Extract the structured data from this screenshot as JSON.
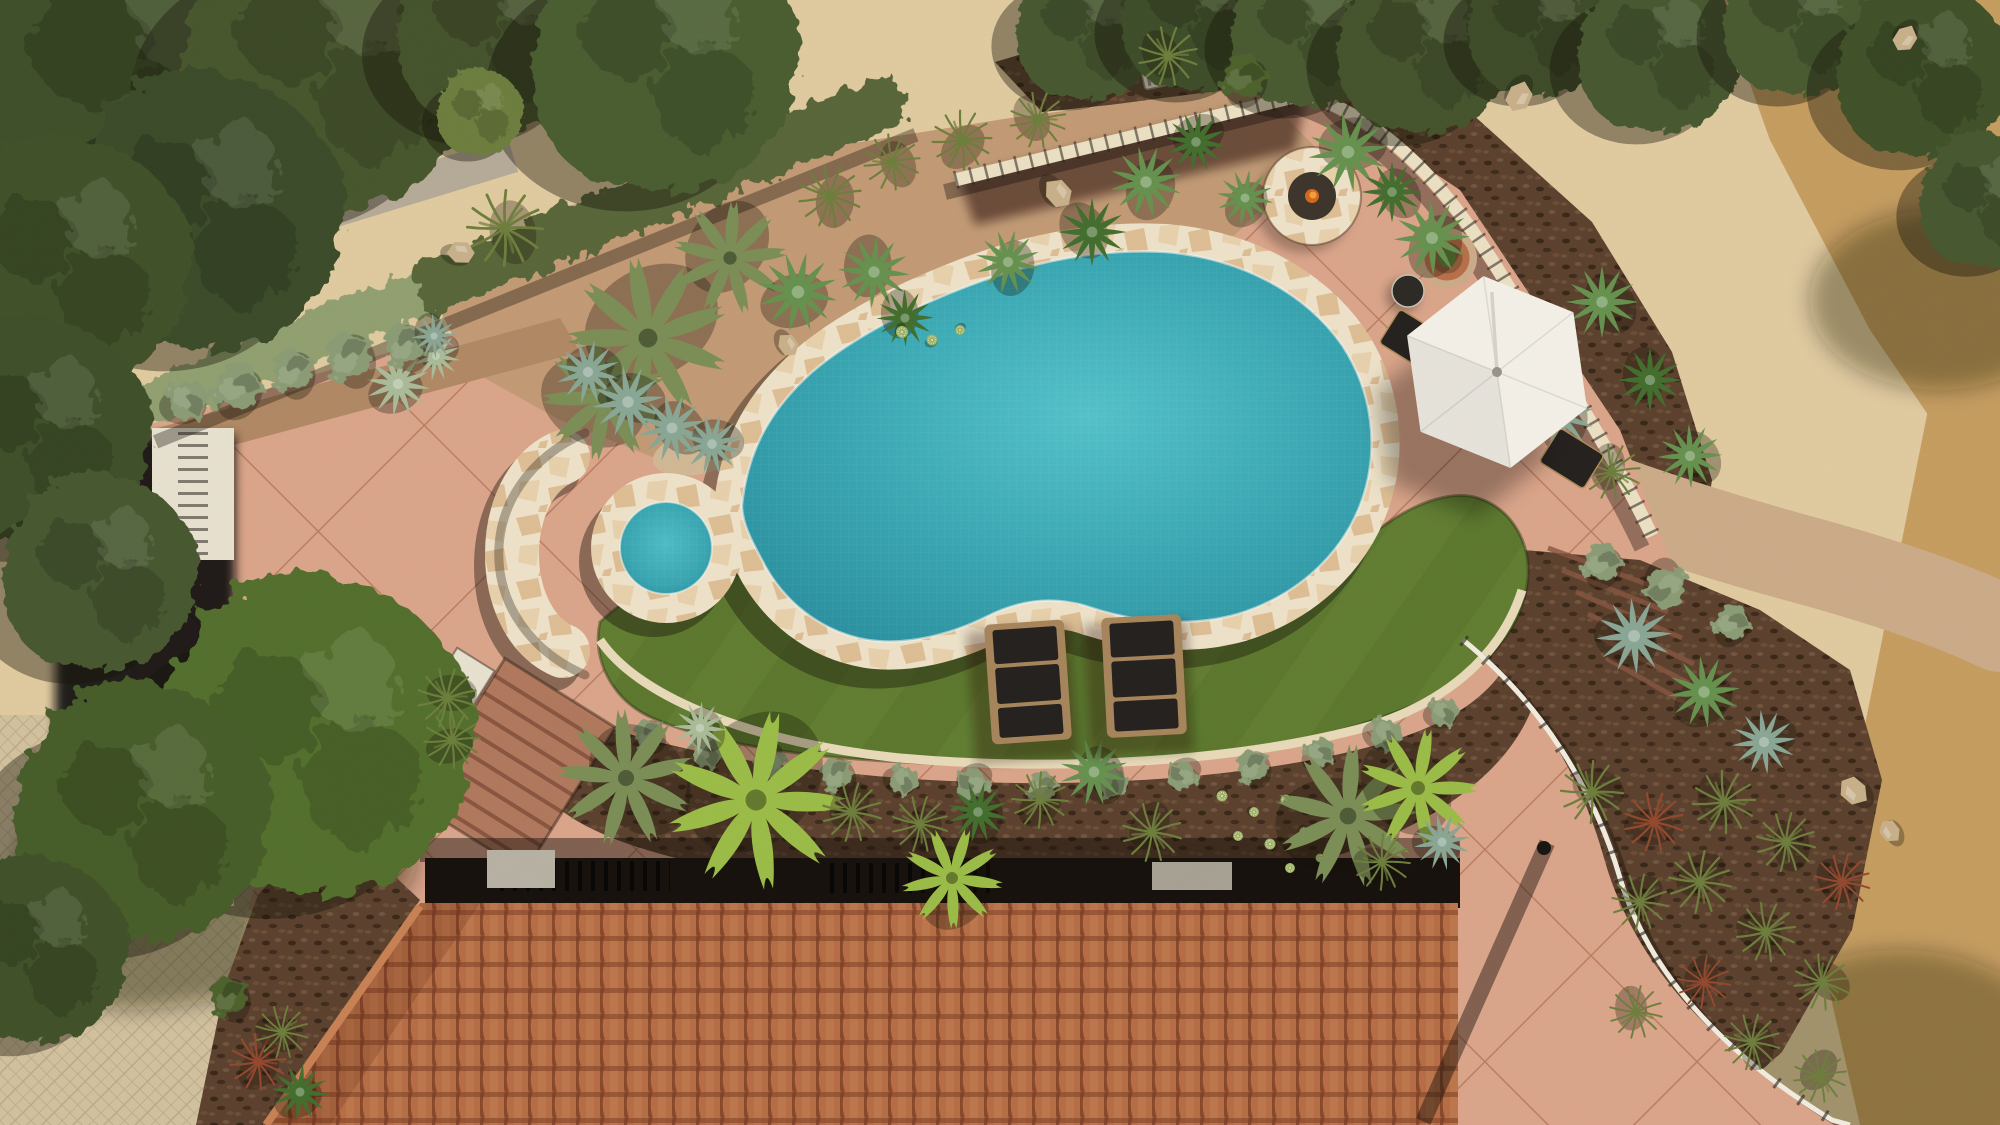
{
  "scene_title": "aerial-backyard-pool-landscape-render",
  "canvas": {
    "width": 2000,
    "height": 1125
  },
  "palette": {
    "sand": "#E2CCA2",
    "sandDark": "#C79F62",
    "gravel": "#B7AC9A",
    "dgBed": "#C49C77",
    "dgBedDark": "#B28A66",
    "dgPath": "#CDAD8A",
    "pebble": "#D3BA97",
    "patio": "#DCA78C",
    "patioLine": "#B27257",
    "flagBase": "#EFE4CB",
    "flagStone1": "#DFC096",
    "flagStone2": "#E9D3AE",
    "water": "#3BAAB6",
    "lawn": "#5E7A2F",
    "lawnLight": "#7A9040",
    "mulch": "#5D432F",
    "mulchLight": "#6E523A",
    "hedgeDark": "#5A683A",
    "hedgeSage": "#93A272",
    "roof": "#B76F47",
    "roofRib": "#8A4A2C",
    "roofLight": "#C98355",
    "roofRow": "#7E4126",
    "drive": "#D3C3A1",
    "driveLine": "#BCAA86",
    "wallCap": "#EDE2C6",
    "wallWhite": "#E9E3D2",
    "wallGray": "#CFC8B6",
    "shadow": "#17120D",
    "umbrella": "#F5F2EA",
    "chairDark": "#262220",
    "chairFrame": "#A8875D",
    "curb": "#E9DCBB",
    "stepTread": "#8A5742",
    "stepPad": "#B27A5F",
    "railing": "#F2EEE2",
    "firepitInner": "#3E362C",
    "flame": "#D4691F",
    "flameLight": "#F2A23C",
    "potRing": "#B9714C",
    "potPlant": "#5E7F3A",
    "plantColors": {
      "palm": "#7D9058",
      "palmBright": "#9DBE49",
      "agave": "#679350",
      "agaveDark": "#44702F",
      "agaveBlue": "#8BA897",
      "agavePale": "#ABBD9B",
      "grass": "#6F803E",
      "grassRed": "#964A30",
      "barrel": "#9FB468",
      "shrub": "#50642F",
      "shrubSage": "#8C9E77",
      "rock": "#C9B28C"
    }
  },
  "scene": {
    "objects": [
      "freeform swimming pool",
      "round spa",
      "flagstone coping",
      "crescent step pad",
      "kidney lawn",
      "2 lounge chairs",
      "hex patio umbrella",
      "2 patio chairs",
      "side table",
      "gas fire pit",
      "salmon concrete patio",
      "curved garden wall",
      "white view railing",
      "tile roof",
      "herringbone driveway",
      "trimmed hedge",
      "desert planting beds",
      "decomposed granite path",
      "paver steps",
      "planter pot",
      "slat bench"
    ],
    "counts": {
      "lounge_chairs": 2,
      "patio_chairs": 2,
      "umbrellas": 1,
      "fire_pits": 1
    },
    "trees": [
      [
        140,
        80,
        1.7,
        "#40512B"
      ],
      [
        330,
        60,
        1.45,
        "#49592F"
      ],
      [
        500,
        28,
        1.0,
        "#46552E"
      ],
      [
        665,
        58,
        1.3,
        "#4C5E33"
      ],
      [
        205,
        212,
        1.35,
        "#3E4E29"
      ],
      [
        68,
        262,
        1.2,
        "#43532C"
      ],
      [
        38,
        432,
        1.1,
        "#40512B"
      ],
      [
        100,
        572,
        0.95,
        "#4A5A30"
      ],
      [
        1088,
        28,
        0.7,
        "#4A5A30"
      ],
      [
        1198,
        14,
        0.75,
        "#414F2A"
      ],
      [
        1308,
        30,
        0.75,
        "#4C5C32"
      ],
      [
        1424,
        46,
        0.85,
        "#47562E"
      ],
      [
        1540,
        24,
        0.7,
        "#3F4E29"
      ],
      [
        1660,
        50,
        0.8,
        "#4A5A30"
      ],
      [
        1800,
        18,
        0.75,
        "#4C5C32"
      ],
      [
        1924,
        70,
        0.85,
        "#43522B"
      ],
      [
        1986,
        200,
        0.65,
        "#4A5A30"
      ],
      [
        315,
        736,
        1.55,
        "#55712F"
      ],
      [
        142,
        812,
        1.25,
        "#4A5E2C"
      ],
      [
        36,
        950,
        0.9,
        "#42522A"
      ],
      [
        480,
        112,
        0.42,
        "#6E8040"
      ]
    ],
    "plants": [
      [
        "palm",
        648,
        338,
        1.35
      ],
      [
        "palm",
        605,
        398,
        1.05
      ],
      [
        "palm",
        730,
        258,
        0.95
      ],
      [
        "agaveBlue",
        588,
        372,
        0.85
      ],
      [
        "agaveBlue",
        628,
        402,
        0.95
      ],
      [
        "agaveBlue",
        672,
        428,
        0.9
      ],
      [
        "agaveBlue",
        712,
        444,
        0.8
      ],
      [
        "agave",
        798,
        292,
        1.05
      ],
      [
        "agave",
        874,
        272,
        0.95
      ],
      [
        "agaveDark",
        905,
        318,
        0.75
      ],
      [
        "grass",
        830,
        196,
        0.95
      ],
      [
        "grass",
        892,
        162,
        0.85
      ],
      [
        "grass",
        962,
        140,
        0.9
      ],
      [
        "grass",
        1038,
        120,
        0.85
      ],
      [
        "barrel",
        902,
        332,
        0.55
      ],
      [
        "barrel",
        932,
        340,
        0.5
      ],
      [
        "barrel",
        960,
        330,
        0.45
      ],
      [
        "agave",
        1008,
        262,
        0.85
      ],
      [
        "agaveDark",
        1092,
        232,
        0.9
      ],
      [
        "agave",
        1146,
        182,
        0.95
      ],
      [
        "agaveDark",
        1196,
        142,
        0.8
      ],
      [
        "agave",
        1245,
        198,
        0.75
      ],
      [
        "rock",
        1058,
        192,
        0.9
      ],
      [
        "rock",
        788,
        344,
        0.7
      ],
      [
        "rock",
        460,
        252,
        0.8
      ],
      [
        "grass",
        505,
        228,
        1.15
      ],
      [
        "agavePale",
        398,
        384,
        0.85
      ],
      [
        "agavePale",
        436,
        356,
        0.65
      ],
      [
        "shrubSage",
        188,
        400,
        0.7
      ],
      [
        "shrubSage",
        238,
        386,
        0.8
      ],
      [
        "shrubSage",
        292,
        370,
        0.7
      ],
      [
        "shrubSage",
        348,
        356,
        0.8
      ],
      [
        "shrubSage",
        404,
        344,
        0.7
      ],
      [
        "agaveBlue",
        434,
        336,
        0.6
      ],
      [
        "grass",
        1168,
        56,
        0.9
      ],
      [
        "shrub",
        1244,
        76,
        0.75
      ],
      [
        "agave",
        1348,
        152,
        1.05
      ],
      [
        "agaveDark",
        1392,
        192,
        0.8
      ],
      [
        "agave",
        1432,
        238,
        1.0
      ],
      [
        "agave",
        1508,
        330,
        1.0
      ],
      [
        "agaveBlue",
        1560,
        416,
        0.9
      ],
      [
        "rock",
        1520,
        96,
        0.9
      ],
      [
        "rock",
        1906,
        38,
        0.8
      ],
      [
        "grass",
        1612,
        472,
        0.85
      ],
      [
        "agave",
        1602,
        302,
        0.95
      ],
      [
        "agaveDark",
        1650,
        380,
        0.85
      ],
      [
        "agave",
        1690,
        456,
        0.85
      ],
      [
        "shrubSage",
        1602,
        562,
        0.65
      ],
      [
        "shrubSage",
        1666,
        588,
        0.7
      ],
      [
        "shrubSage",
        1732,
        622,
        0.6
      ],
      [
        "agaveBlue",
        1634,
        636,
        1.0
      ],
      [
        "agave",
        1704,
        692,
        0.95
      ],
      [
        "agaveBlue",
        1764,
        742,
        0.85
      ],
      [
        "grass",
        1592,
        792,
        0.95
      ],
      [
        "grassRed",
        1654,
        822,
        0.9
      ],
      [
        "grass",
        1724,
        802,
        0.95
      ],
      [
        "grass",
        1786,
        842,
        0.9
      ],
      [
        "grassRed",
        1842,
        882,
        0.85
      ],
      [
        "grass",
        1700,
        882,
        0.95
      ],
      [
        "grass",
        1640,
        902,
        0.85
      ],
      [
        "grass",
        1766,
        932,
        0.9
      ],
      [
        "grass",
        1822,
        982,
        0.85
      ],
      [
        "grassRed",
        1704,
        982,
        0.8
      ],
      [
        "grass",
        1636,
        1012,
        0.8
      ],
      [
        "grass",
        1752,
        1042,
        0.85
      ],
      [
        "grass",
        1820,
        1076,
        0.8
      ],
      [
        "rock",
        1854,
        792,
        0.9
      ],
      [
        "rock",
        1890,
        832,
        0.7
      ],
      [
        "shrubSage",
        648,
        734,
        0.5
      ],
      [
        "shrubSage",
        708,
        752,
        0.55
      ],
      [
        "shrubSage",
        770,
        764,
        0.5
      ],
      [
        "shrubSage",
        836,
        774,
        0.55
      ],
      [
        "shrubSage",
        904,
        780,
        0.5
      ],
      [
        "shrubSage",
        972,
        784,
        0.55
      ],
      [
        "shrubSage",
        1042,
        786,
        0.5
      ],
      [
        "shrubSage",
        1112,
        782,
        0.55
      ],
      [
        "shrubSage",
        1182,
        776,
        0.5
      ],
      [
        "shrubSage",
        1252,
        766,
        0.55
      ],
      [
        "shrubSage",
        1320,
        752,
        0.5
      ],
      [
        "shrubSage",
        1386,
        734,
        0.55
      ],
      [
        "shrubSage",
        1444,
        712,
        0.5
      ],
      [
        "palm",
        626,
        778,
        1.15
      ],
      [
        "palmBright",
        756,
        800,
        1.5
      ],
      [
        "agavePale",
        700,
        728,
        0.7
      ],
      [
        "grass",
        852,
        812,
        0.9
      ],
      [
        "grass",
        920,
        824,
        0.85
      ],
      [
        "agaveDark",
        978,
        812,
        0.8
      ],
      [
        "grass",
        1040,
        800,
        0.85
      ],
      [
        "agave",
        1094,
        772,
        0.9
      ],
      [
        "grass",
        1152,
        832,
        0.9
      ],
      [
        "barrel",
        1222,
        796,
        0.5
      ],
      [
        "barrel",
        1254,
        812,
        0.45
      ],
      [
        "barrel",
        1286,
        800,
        0.5
      ],
      [
        "barrel",
        1238,
        836,
        0.45
      ],
      [
        "barrel",
        1270,
        844,
        0.5
      ],
      [
        "barrel",
        1304,
        832,
        0.45
      ],
      [
        "barrel",
        1320,
        858,
        0.4
      ],
      [
        "barrel",
        1290,
        868,
        0.45
      ],
      [
        "palm",
        1348,
        816,
        1.2
      ],
      [
        "palmBright",
        1418,
        788,
        1.0
      ],
      [
        "grass",
        1382,
        862,
        0.85
      ],
      [
        "agaveBlue",
        1442,
        842,
        0.75
      ],
      [
        "palmBright",
        952,
        878,
        0.85
      ],
      [
        "grass",
        447,
        698,
        0.9
      ],
      [
        "grass",
        452,
        740,
        0.85
      ],
      [
        "shrub",
        228,
        996,
        0.65
      ],
      [
        "grassRed",
        258,
        1062,
        0.85
      ],
      [
        "agaveDark",
        300,
        1092,
        0.75
      ],
      [
        "grass",
        282,
        1032,
        0.8
      ]
    ]
  },
  "furniture": {
    "umbrella": {
      "x": 1497,
      "y": 372,
      "rot": -8
    },
    "loungers": [
      {
        "x": 1028,
        "y": 682,
        "rot": -4
      },
      {
        "x": 1144,
        "y": 676,
        "rot": -3
      }
    ],
    "fire_pit": {
      "x": 1312,
      "y": 196,
      "rot": 0
    },
    "side_table": {
      "x": 1408,
      "y": 291,
      "rot": 0
    },
    "bench": {
      "x": 1186,
      "y": 70,
      "rot": -12
    },
    "pot": {
      "x": 1447,
      "y": 258,
      "rot": 0
    },
    "steps_left": {
      "x": 515,
      "y": 765,
      "rot": 32
    },
    "planter_box": {
      "x": 443,
      "y": 712,
      "rot": 32
    }
  }
}
